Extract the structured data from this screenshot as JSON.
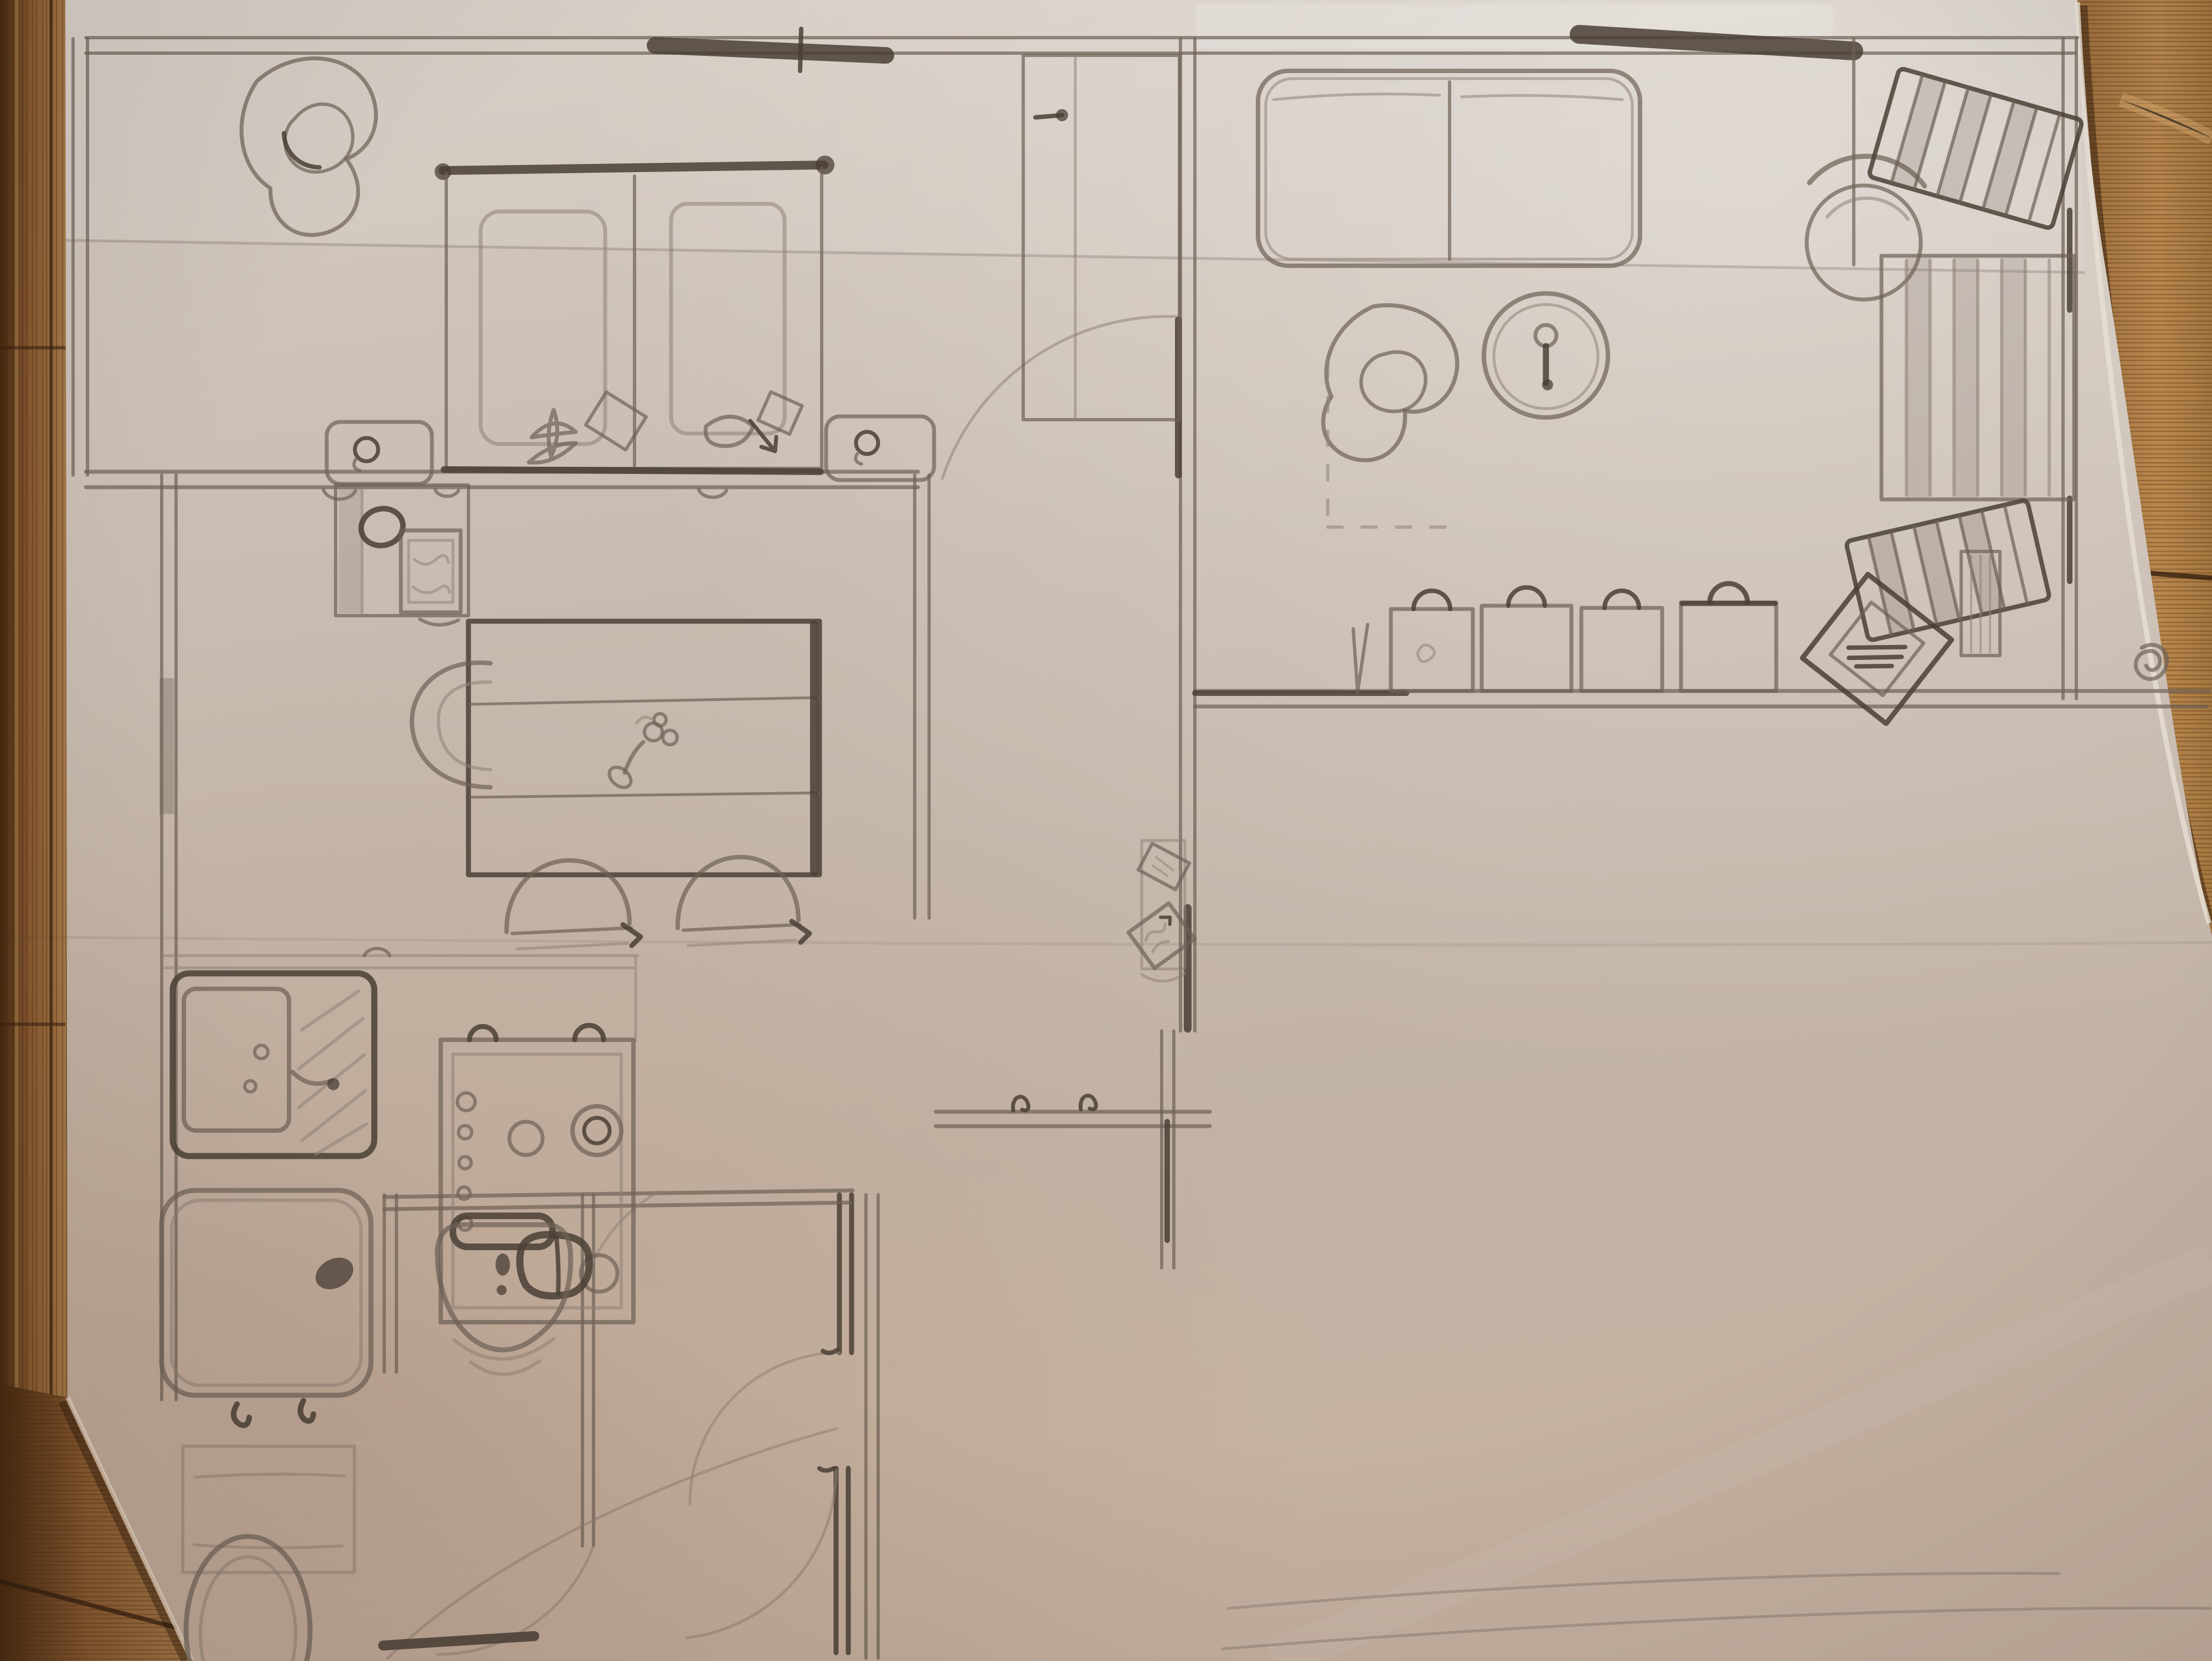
{
  "scene": {
    "title": "Hand-drawn apartment floor plan, pencil on folded paper, photographed on a wooden table",
    "medium": "graphite pencil sketch",
    "paper": "white sheet with horizontal fold creases, right edge curled, tape shine at top",
    "surface": "oak-grain wooden table visible at left edge, bottom-left corner and right edge"
  },
  "colors": {
    "paper_base": "#c7bbaf",
    "paper_light": "#d8cfc6",
    "paper_warm_shadow": "#bba799",
    "pencil_light": "#8f8276",
    "pencil_mid": "#6e6156",
    "pencil_dark": "#4a3f35",
    "wood_dark": "#3a2412",
    "wood_mid": "#8a5a30",
    "wood_light": "#c89a62"
  },
  "plan": {
    "rooms": [
      {
        "name": "bedroom (top-left)",
        "furniture": [
          "crescent corner armchair",
          "twin beds with shared dark headboard rail and knobs",
          "two duvets",
          "flower doodles at bed foot",
          "left nightstand with lamp swirl",
          "right nightstand with lamp swirl",
          "hatched window on top wall",
          "coat hooks under bottom wall"
        ]
      },
      {
        "name": "living room (top-right)",
        "furniture": [
          "two-cushion sofa",
          "hatched window on top wall",
          "crescent armchair",
          "round table / clock with center glyph",
          "dashed layout lines",
          "round chair beside stairs",
          "straight stair flight with striped treads",
          "curved winder steps above and below flight",
          "row of five bags with arc handles along wall",
          "tilted double-border picture frame with scribbles",
          "radiator under right wall",
          "small spiral door knob mark"
        ]
      },
      {
        "name": "dining room (middle-left)",
        "furniture": [
          "side cabinet with bowl and framed scribble picture",
          "large dining table with two cross lines and flower centerpiece doodle",
          "two arch-back chairs",
          "half-round chair",
          "shaded window strip on left wall"
        ]
      },
      {
        "name": "kitchen (left-middle)",
        "furniture": [
          "counter line with hook",
          "sink unit with basin, hatched drainboard, faucet and knobs",
          "stove with inner frame, five control knobs, three burners, double-ring burner, dark kettle, two hanger arcs"
        ]
      },
      {
        "name": "bathroom (bottom-left)",
        "furniture": [
          "bathtub with dark faucet oval and two feet",
          "bath mat",
          "washbasin with dark tap bar and drain",
          "toilet bowl (cut by photo edge)"
        ]
      },
      {
        "name": "hallway / entry (center)",
        "furniture": [
          "tall wardrobe with knob",
          "door leaf and quarter-circle swing arc",
          "narrow console with two tilted frames",
          "entry wall with two coat hooks",
          "double door-swing arcs into washroom",
          "dark thresholds",
          "large hall swing arc"
        ]
      }
    ],
    "structure": [
      "double-line outer walls",
      "top wall with two dark hatched window bands",
      "inner partition walls",
      "faint bottom boundary lines running off the sheet"
    ]
  },
  "photo_features": [
    "upper fold crease across sheet",
    "middle faint crease",
    "glossy tape band top-right",
    "vignette lighting",
    "paper edge shadow on wood"
  ]
}
